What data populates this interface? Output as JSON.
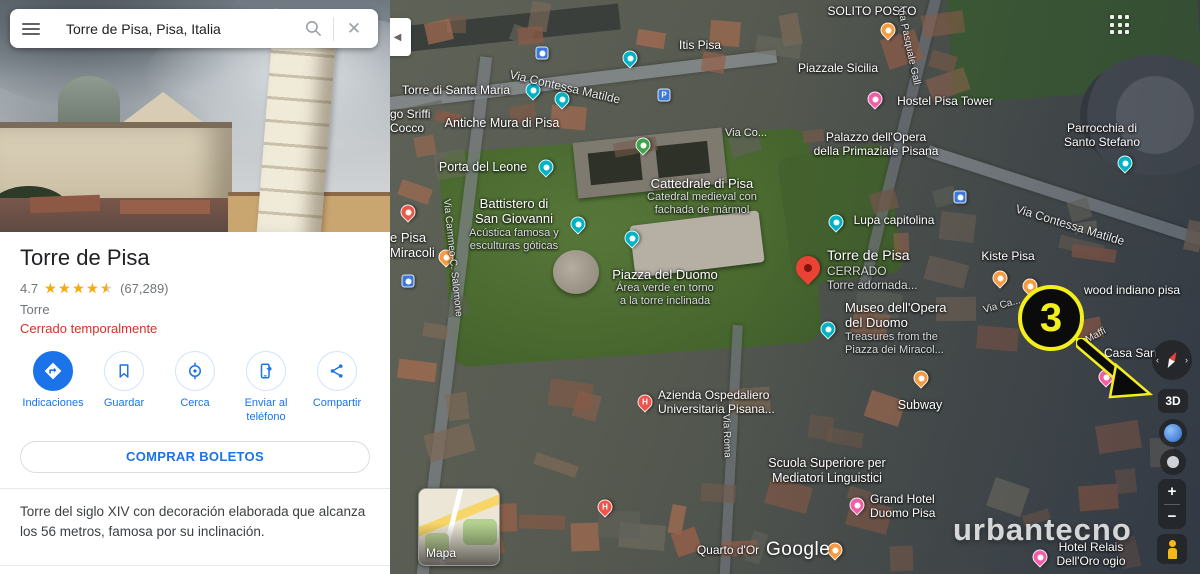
{
  "sidebar": {
    "search": {
      "value": "Torre de Pisa, Pisa, Italia"
    },
    "place": {
      "name": "Torre de Pisa",
      "rating": "4.7",
      "stars": 4.5,
      "reviews": "(67,289)",
      "category": "Torre",
      "status": "Cerrado temporalmente"
    },
    "actions": [
      {
        "label": "Indicaciones",
        "icon": "directions-icon"
      },
      {
        "label": "Guardar",
        "icon": "bookmark-icon"
      },
      {
        "label": "Cerca",
        "icon": "nearby-icon"
      },
      {
        "label": "Enviar al teléfono",
        "icon": "send-to-phone-icon"
      },
      {
        "label": "Compartir",
        "icon": "share-icon"
      }
    ],
    "cta_label": "COMPRAR BOLETOS",
    "description": "Torre del siglo XIV con decoración elaborada que alcanza los 56 metros, famosa por su inclinación."
  },
  "map": {
    "watermark": "urbantecno",
    "google_logo": "Google",
    "toggle_label": "Mapa",
    "annotation_number": "3",
    "controls": {
      "three_d": "3D",
      "zoom_in": "+",
      "zoom_out": "−"
    },
    "colors": {
      "accent_blue": "#1a73e8",
      "status_red": "#d93025",
      "annotation_yellow": "#f2ef1d",
      "pin_red": "#EA4335",
      "pin_teal": "#00b3c4"
    },
    "labels": [
      {
        "lines": [
          "SOLITO POSTO"
        ],
        "x": 482,
        "y": 4
      },
      {
        "lines": [
          "Itis Pisa"
        ],
        "x": 310,
        "y": 38
      },
      {
        "lines": [
          "Piazzale Sicilia"
        ],
        "x": 448,
        "y": 61
      },
      {
        "lines": [
          "Hostel Pisa Tower"
        ],
        "x": 555,
        "y": 94
      },
      {
        "lines": [
          "Torre di Santa Maria"
        ],
        "x": 66,
        "y": 83
      },
      {
        "lines": [
          "go Sriffi",
          "Cocco"
        ],
        "x": 0,
        "y": 107,
        "align": "left"
      },
      {
        "lines": [
          "Antiche Mura di Pisa"
        ],
        "x": 112,
        "y": 116,
        "size": 12.5
      },
      {
        "lines": [
          "Parrocchia di",
          "Santo Stefano"
        ],
        "x": 712,
        "y": 121
      },
      {
        "lines": [
          "Palazzo dell'Opera",
          "della Primaziale Pisana"
        ],
        "x": 486,
        "y": 130
      },
      {
        "lines": [
          "Via Co..."
        ],
        "x": 356,
        "y": 127,
        "size": 11,
        "street": true
      },
      {
        "lines": [
          "Porta del Leone"
        ],
        "x": 93,
        "y": 160,
        "size": 12.5
      },
      {
        "lines": [
          "Cattedrale di Pisa"
        ],
        "sub": [
          "Catedral medieval con",
          "fachada de mármol"
        ],
        "x": 312,
        "y": 176,
        "size": 13
      },
      {
        "lines": [
          "Battistero di",
          "San Giovanni"
        ],
        "sub": [
          "Acústica famosa y",
          "esculturas góticas"
        ],
        "x": 124,
        "y": 196,
        "size": 13
      },
      {
        "lines": [
          "Piazza del Duomo"
        ],
        "sub": [
          "Área verde en torno",
          "a la torre inclinada"
        ],
        "x": 275,
        "y": 267,
        "size": 13
      },
      {
        "lines": [
          "Lupa capitolina"
        ],
        "x": 504,
        "y": 213
      },
      {
        "lines": [
          "Torre de Pisa"
        ],
        "sub": [
          "CERRADO",
          "Torre adornada..."
        ],
        "x": 437,
        "y": 247,
        "size": 14,
        "align": "left"
      },
      {
        "lines": [
          "Kiste Pisa"
        ],
        "x": 618,
        "y": 249
      },
      {
        "lines": [
          "wood indiano pisa"
        ],
        "x": 742,
        "y": 283
      },
      {
        "lines": [
          "Casa San"
        ],
        "x": 714,
        "y": 346,
        "align": "left"
      },
      {
        "lines": [
          "Maffi"
        ],
        "x": 706,
        "y": 330,
        "size": 10,
        "rotate": -28,
        "street": true
      },
      {
        "lines": [
          "Museo dell'Opera",
          "del Duomo"
        ],
        "sub": [
          "Treasures from the",
          "Piazza dei Miracol..."
        ],
        "x": 455,
        "y": 300,
        "size": 13,
        "align": "left"
      },
      {
        "lines": [
          "Subway"
        ],
        "x": 530,
        "y": 398,
        "size": 12.5
      },
      {
        "lines": [
          "Azienda Ospedaliero",
          "Universitaria Pisana..."
        ],
        "x": 268,
        "y": 388,
        "align": "left"
      },
      {
        "lines": [
          "Scuola Superiore per",
          "Mediatori Linguistici"
        ],
        "x": 437,
        "y": 456,
        "size": 12.5
      },
      {
        "lines": [
          "Grand Hotel",
          "Duomo  Pisa"
        ],
        "x": 480,
        "y": 492,
        "align": "left"
      },
      {
        "lines": [
          "Quarto d'Or"
        ],
        "x": 338,
        "y": 543
      },
      {
        "lines": [
          "Hotel Relais",
          "Dell'Oro ogio"
        ],
        "x": 701,
        "y": 540
      },
      {
        "lines": [
          "e Pisa",
          "Miracoli"
        ],
        "x": 0,
        "y": 230,
        "size": 13,
        "align": "left"
      },
      {
        "lines": [
          "Via Contessa Matilde"
        ],
        "x": 175,
        "y": 80,
        "rotate": 13,
        "street": true
      },
      {
        "lines": [
          "Via Contessa Matilde"
        ],
        "x": 680,
        "y": 218,
        "rotate": 17,
        "street": true
      },
      {
        "lines": [
          "Via Ca..."
        ],
        "x": 612,
        "y": 300,
        "size": 10,
        "rotate": -15,
        "street": true
      },
      {
        "lines": [
          "Via Pasquale Gall"
        ],
        "x": 518,
        "y": 40,
        "size": 10,
        "rotate": 78,
        "street": true
      },
      {
        "lines": [
          "Via Cammeo C. Salomone"
        ],
        "x": 62,
        "y": 252,
        "size": 10,
        "rotate": 84,
        "street": true
      },
      {
        "lines": [
          "Via Roma"
        ],
        "x": 336,
        "y": 430,
        "size": 10,
        "rotate": 88,
        "street": true
      }
    ],
    "pins": [
      {
        "type": "school",
        "x": 240,
        "y": 58
      },
      {
        "type": "camera",
        "x": 143,
        "y": 90
      },
      {
        "type": "museum",
        "x": 172,
        "y": 99
      },
      {
        "type": "camera",
        "x": 156,
        "y": 167
      },
      {
        "type": "park",
        "x": 253,
        "y": 145
      },
      {
        "type": "monument",
        "x": 188,
        "y": 224
      },
      {
        "type": "monument",
        "x": 242,
        "y": 238
      },
      {
        "type": "star",
        "x": 18,
        "y": 212
      },
      {
        "type": "restaurant",
        "x": 56,
        "y": 257
      },
      {
        "type": "transit",
        "x": 18,
        "y": 281
      },
      {
        "type": "transit",
        "x": 152,
        "y": 53
      },
      {
        "type": "parking",
        "x": 274,
        "y": 95
      },
      {
        "type": "transit",
        "x": 570,
        "y": 197
      },
      {
        "type": "main",
        "x": 418,
        "y": 268
      },
      {
        "type": "museum",
        "x": 438,
        "y": 329
      },
      {
        "type": "monument",
        "x": 446,
        "y": 222
      },
      {
        "type": "church",
        "x": 735,
        "y": 163
      },
      {
        "type": "restaurant",
        "x": 610,
        "y": 278
      },
      {
        "type": "restaurant",
        "x": 640,
        "y": 286
      },
      {
        "type": "restaurant",
        "x": 498,
        "y": 30
      },
      {
        "type": "hotel",
        "x": 485,
        "y": 99
      },
      {
        "type": "restaurant",
        "x": 531,
        "y": 378
      },
      {
        "type": "hospital",
        "x": 255,
        "y": 402
      },
      {
        "type": "hospital",
        "x": 215,
        "y": 507
      },
      {
        "type": "hotel",
        "x": 467,
        "y": 505
      },
      {
        "type": "restaurant",
        "x": 445,
        "y": 550
      },
      {
        "type": "hotel",
        "x": 650,
        "y": 557
      },
      {
        "type": "hotel",
        "x": 716,
        "y": 377
      }
    ]
  }
}
